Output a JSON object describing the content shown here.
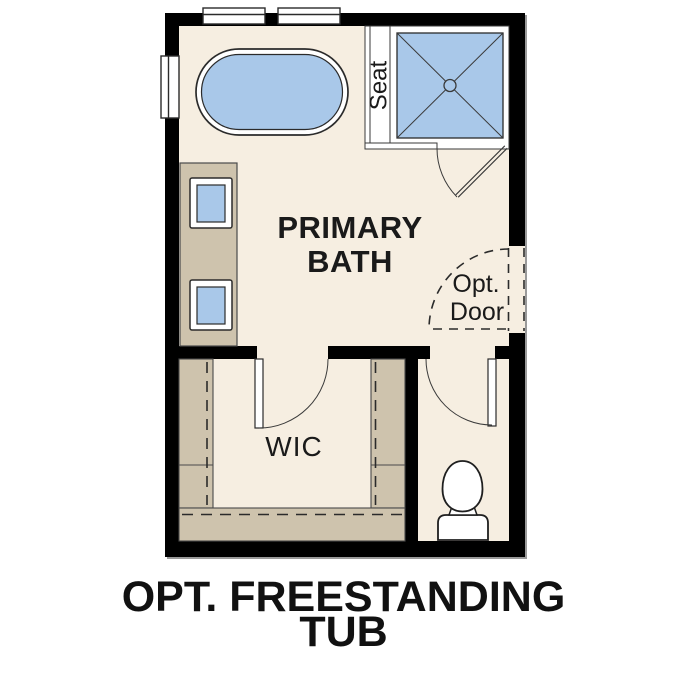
{
  "plan": {
    "caption": "OPT. FREESTANDING TUB",
    "labels": {
      "primary_bath_line1": "PRIMARY",
      "primary_bath_line2": "BATH",
      "wic": "WIC",
      "shower_seat": "Seat",
      "opt_door_line1": "Opt.",
      "opt_door_line2": "Door"
    },
    "fixtures": {
      "tub": "freestanding-tub",
      "shower": "walk-in-shower-with-seat",
      "vanity": "double-sink-vanity",
      "toilet": "toilet",
      "windows": "window-symbols",
      "doors": "swing-door-symbols",
      "optional_door": "dashed-optional-door"
    },
    "colors": {
      "wall": "#000000",
      "floor": "#f6eee1",
      "cabinetry": "#cec3ad",
      "water_fixture_fill": "#a9c8e9",
      "fixture_outline": "#2b2b2b",
      "text": "#1a1a1a",
      "background": "#ffffff"
    }
  }
}
